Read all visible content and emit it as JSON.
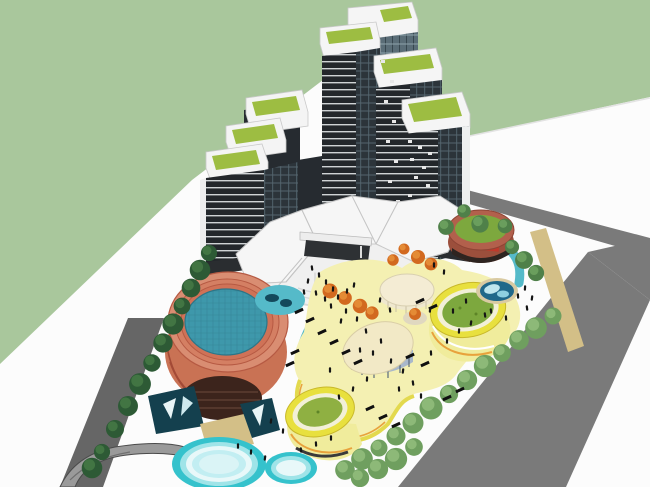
{
  "scene": {
    "description": "aerial axonometric 3D render of mixed-use complex: dark glass towers with green roofs, white faceted podium, terracotta drum with rooftop pool, yellow oval pavilions with green roofs on pale-yellow deck, plazas, pools, tree-lined roads",
    "palette": {
      "backdrop_green": "#a9c79c",
      "ground_white": "#fcfcfc",
      "road_dark": "#666666",
      "road_main": "#7a7a7a",
      "tan_path": "#d3bf87",
      "deck_yellow": "#f4f0b2",
      "deck_edge_yellow": "#e3d94e",
      "deck_edge_orange": "#e8a23c",
      "oval_rim_yellow": "#e8e03e",
      "oval_ring_white": "#f2f0d8",
      "roof_green": "#7da83e",
      "tower_roof_green": "#9dbd42",
      "cream_top": "#f4ecd4",
      "cream_big": "#f2e9c6",
      "glass_band_blue": "#a9b8cb",
      "terracotta_rim": "#b2604c",
      "terracotta_side": "#9c4f3c",
      "cyl_ring_light": "#d98d72",
      "cyl_ring_mid": "#d47f63",
      "cyl_ring_deep": "#cf7257",
      "cyl_body": "#c97254",
      "cyl_base_dark": "#3c241c",
      "pool_teal": "#3e98ab",
      "canal_teal": "#55bac9",
      "pond_deep": "#20688a",
      "basin_dark": "#14404e",
      "pool_cyan": "#35c2cc",
      "pool_cyan_light": "#9fe4e8",
      "pool_white": "#e8f8f9",
      "tree_dark": "#2d5a35",
      "tree_dark_hi": "#477a45",
      "tree_light": "#6f9f5f",
      "tree_light_hi": "#93bd7d",
      "tree_green": "#4f8049",
      "tree_green_hi": "#6fa360",
      "tree_orange": "#d2691f",
      "tree_orange_hi": "#e8923a",
      "facet_white": "#f6f6f6",
      "facet_line": "#c4c4c4",
      "entry_dark": "#2e3134",
      "people_black": "#151515",
      "ramp_gray": "#9a9a9a"
    },
    "trees": {
      "dark_row": [
        [
          209,
          253
        ],
        [
          200,
          270
        ],
        [
          191,
          288
        ],
        [
          182,
          306
        ],
        [
          173,
          324
        ],
        [
          163,
          343
        ],
        [
          152,
          363
        ],
        [
          140,
          384
        ],
        [
          128,
          406
        ],
        [
          115,
          429
        ],
        [
          102,
          452
        ],
        [
          92,
          468
        ]
      ],
      "light_row": [
        [
          553,
          316
        ],
        [
          536,
          328
        ],
        [
          519,
          340
        ],
        [
          502,
          353
        ],
        [
          485,
          366
        ],
        [
          467,
          380
        ],
        [
          449,
          394
        ],
        [
          431,
          408
        ],
        [
          413,
          423
        ],
        [
          396,
          436
        ],
        [
          379,
          448
        ],
        [
          362,
          459
        ],
        [
          345,
          470
        ],
        [
          414,
          447
        ],
        [
          396,
          459
        ],
        [
          378,
          469
        ],
        [
          360,
          478
        ]
      ],
      "green_cluster": [
        [
          464,
          211
        ],
        [
          480,
          224
        ],
        [
          446,
          227
        ],
        [
          512,
          247
        ],
        [
          524,
          260
        ],
        [
          536,
          273
        ],
        [
          505,
          226
        ]
      ],
      "orange": [
        [
          404,
          249
        ],
        [
          418,
          257
        ],
        [
          431,
          264
        ],
        [
          393,
          260
        ],
        [
          360,
          306
        ],
        [
          372,
          313
        ],
        [
          415,
          314
        ],
        [
          330,
          291
        ],
        [
          345,
          298
        ]
      ]
    },
    "people": [
      [
        312,
        268
      ],
      [
        319,
        275
      ],
      [
        326,
        282
      ],
      [
        333,
        289
      ],
      [
        308,
        281
      ],
      [
        316,
        293
      ],
      [
        325,
        299
      ],
      [
        338,
        297
      ],
      [
        347,
        291
      ],
      [
        354,
        285
      ],
      [
        304,
        292
      ],
      [
        331,
        306
      ],
      [
        346,
        311
      ],
      [
        357,
        319
      ],
      [
        341,
        321
      ],
      [
        366,
        331
      ],
      [
        381,
        341
      ],
      [
        373,
        353
      ],
      [
        391,
        361
      ],
      [
        403,
        371
      ],
      [
        413,
        383
      ],
      [
        399,
        389
      ],
      [
        421,
        396
      ],
      [
        367,
        379
      ],
      [
        353,
        389
      ],
      [
        339,
        397
      ],
      [
        431,
        353
      ],
      [
        447,
        341
      ],
      [
        459,
        331
      ],
      [
        471,
        323
      ],
      [
        485,
        315
      ],
      [
        466,
        301
      ],
      [
        453,
        311
      ],
      [
        525,
        288
      ],
      [
        532,
        298
      ],
      [
        527,
        308
      ],
      [
        518,
        296
      ],
      [
        238,
        446
      ],
      [
        251,
        452
      ],
      [
        265,
        458
      ],
      [
        301,
        450
      ],
      [
        316,
        444
      ],
      [
        331,
        438
      ],
      [
        283,
        431
      ],
      [
        271,
        421
      ],
      [
        491,
        311
      ],
      [
        506,
        318
      ],
      [
        434,
        265
      ],
      [
        444,
        272
      ],
      [
        380,
        300
      ],
      [
        390,
        310
      ],
      [
        360,
        350
      ],
      [
        330,
        370
      ],
      [
        430,
        310
      ]
    ],
    "benches": [
      [
        322,
        332
      ],
      [
        334,
        342
      ],
      [
        346,
        352
      ],
      [
        310,
        320
      ],
      [
        358,
        362
      ],
      [
        299,
        311
      ],
      [
        370,
        408
      ],
      [
        383,
        417
      ],
      [
        396,
        425
      ],
      [
        420,
        301
      ],
      [
        433,
        307
      ],
      [
        447,
        398
      ],
      [
        460,
        390
      ],
      [
        295,
        352
      ],
      [
        290,
        364
      ],
      [
        410,
        356
      ],
      [
        425,
        364
      ]
    ],
    "tower_windows": [
      [
        408,
        140
      ],
      [
        418,
        146
      ],
      [
        428,
        152
      ],
      [
        410,
        158
      ],
      [
        422,
        166
      ],
      [
        414,
        176
      ],
      [
        426,
        184
      ],
      [
        408,
        194
      ],
      [
        420,
        202
      ],
      [
        430,
        210
      ],
      [
        412,
        220
      ],
      [
        424,
        230
      ],
      [
        416,
        240
      ],
      [
        428,
        248
      ],
      [
        381,
        60
      ],
      [
        390,
        80
      ],
      [
        384,
        100
      ],
      [
        392,
        120
      ],
      [
        386,
        140
      ],
      [
        394,
        160
      ],
      [
        388,
        180
      ],
      [
        396,
        200
      ],
      [
        390,
        220
      ],
      [
        382,
        230
      ]
    ]
  }
}
